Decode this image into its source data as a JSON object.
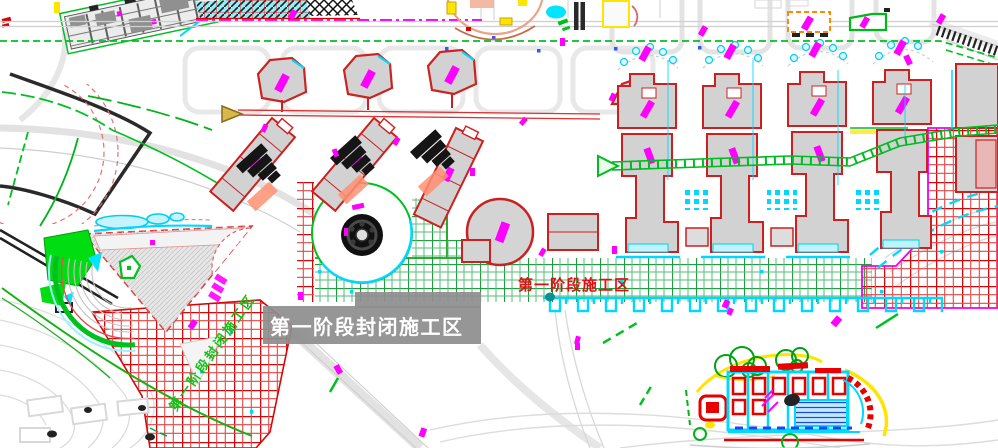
{
  "drawing": {
    "type": "construction-site-plan",
    "labels": {
      "phase1_closed_zone": "第一阶段封闭施工区",
      "phase1_work_zone": "第一阶段施工区",
      "phase1_fence_note": "第一阶段封闭施工区"
    },
    "legend_colors": {
      "closed_zone_hatch": "#d40808",
      "work_zone_hatch": "#1e9e40",
      "label_box": "#8e8e8e",
      "label_text": "#ffffff",
      "work_zone_text": "#e01010",
      "fence_note_text": "#12c112"
    }
  }
}
